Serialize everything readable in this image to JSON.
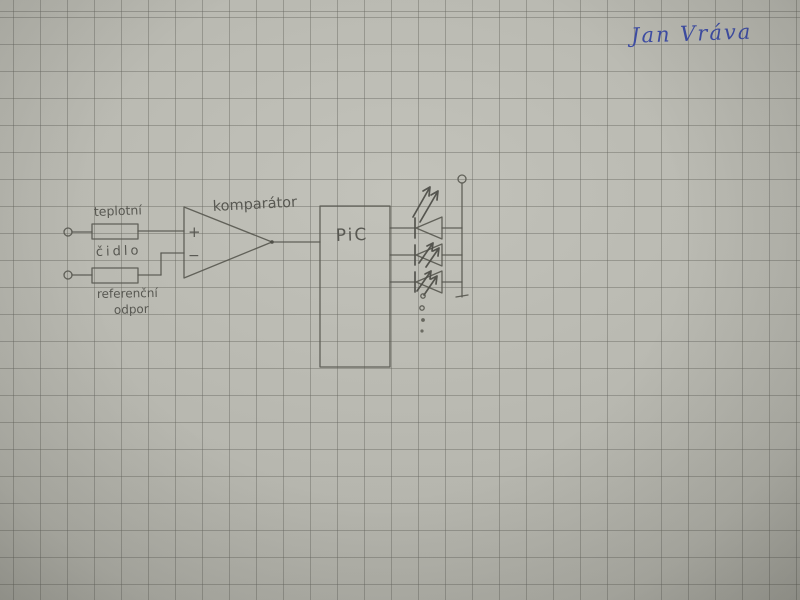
{
  "signature": {
    "text": "Jan Vráva",
    "ink_color": "#3e4da5"
  },
  "schematic": {
    "labels": {
      "sensor_top": "teplotní",
      "sensor_bottom": "čidlo",
      "reference_top": "referenční",
      "reference_bottom": "odpor",
      "comparator": "komparátor",
      "mcu": "PiC",
      "input_plus": "+",
      "input_minus": "−"
    },
    "components": [
      {
        "id": "temperature-sensor",
        "type": "resistor",
        "label": "teplotní čidlo"
      },
      {
        "id": "reference-resistor",
        "type": "resistor",
        "label": "referenční odpor"
      },
      {
        "id": "comparator",
        "type": "comparator",
        "label": "komparátor",
        "inputs": [
          "+",
          "−"
        ]
      },
      {
        "id": "mcu",
        "type": "microcontroller",
        "label": "PiC"
      },
      {
        "id": "led-array",
        "type": "led-row",
        "leds_drawn": 3,
        "continuation_dots": 4
      }
    ],
    "colors": {
      "paper": "#b6b6ae",
      "grid_line": "#8f8f88",
      "pencil": "#56564f"
    }
  }
}
